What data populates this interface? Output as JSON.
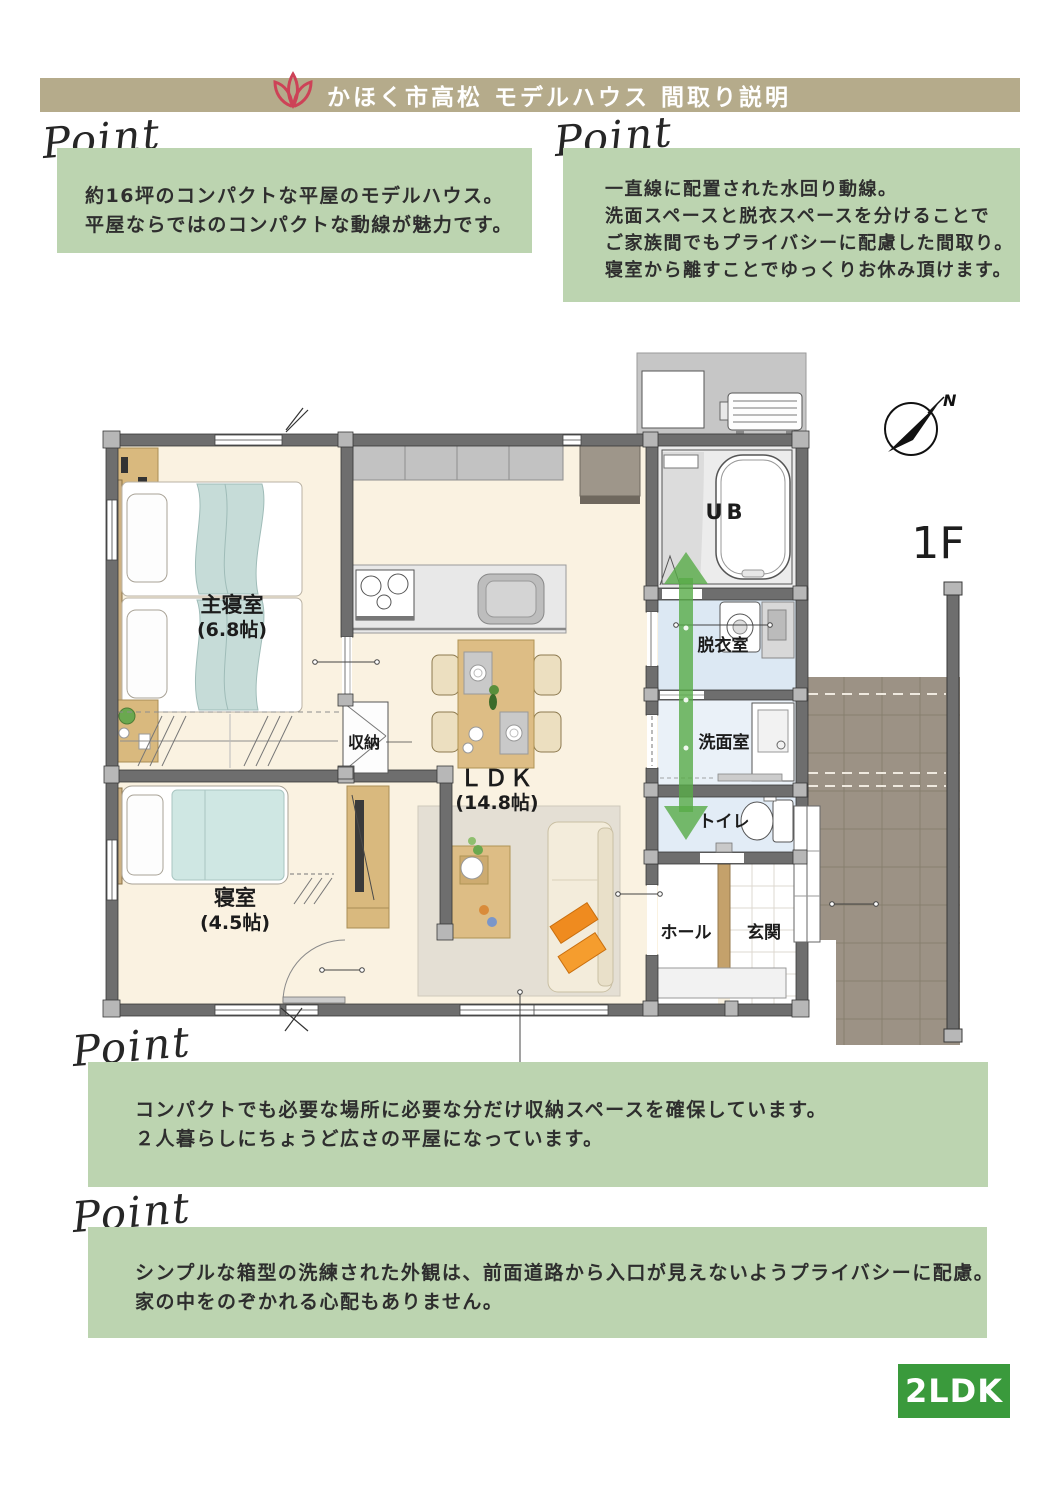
{
  "header": {
    "title": "かほく市高松 モデルハウス 間取り説明",
    "logo_icon": "flower-icon",
    "bar_color": "#b5ab8b"
  },
  "points": [
    {
      "heading": "Point",
      "lines": [
        "約16坪のコンパクトな平屋のモデルハウス。",
        "平屋ならではのコンパクトな動線が魅力です。"
      ]
    },
    {
      "heading": "Point",
      "lines": [
        "一直線に配置された水回り動線。",
        "洗面スペースと脱衣スペースを分けることで",
        "ご家族間でもプライバシーに配慮した間取り。",
        "寝室から離すことでゆっくりお休み頂けます。"
      ]
    },
    {
      "heading": "Point",
      "lines": [
        "コンパクトでも必要な場所に必要な分だけ収納スペースを確保しています。",
        "２人暮らしにちょうど広さの平屋になっています。"
      ]
    },
    {
      "heading": "Point",
      "lines": [
        "シンプルな箱型の洗練された外観は、前面道路から入口が見えないようプライバシーに配慮。",
        "家の中をのぞかれる心配もありません。"
      ]
    }
  ],
  "floorplan": {
    "floor_label": "1F",
    "north_label": "N",
    "rooms": [
      {
        "name": "主寝室",
        "size": "(6.8帖)"
      },
      {
        "name": "寝室",
        "size": "(4.5帖)"
      },
      {
        "name": "ＬＤＫ",
        "size": "(14.8帖)"
      },
      {
        "name": "収納"
      },
      {
        "name": "UB"
      },
      {
        "name": "脱衣室"
      },
      {
        "name": "洗面室"
      },
      {
        "name": "トイレ"
      },
      {
        "name": "ホール"
      },
      {
        "name": "玄関"
      }
    ]
  },
  "badge": {
    "label": "2LDK",
    "color": "#3a9a3c"
  },
  "colors": {
    "point_box_green": "#bcd4b0",
    "flow_arrow_green": "#58ab47",
    "logo_red": "#cd4257",
    "floor_cream": "#faf2e1",
    "wet_floor_blue": "#dce8f3",
    "porch_tile": "#9c9285",
    "wall_gray": "#6e6e6e"
  }
}
